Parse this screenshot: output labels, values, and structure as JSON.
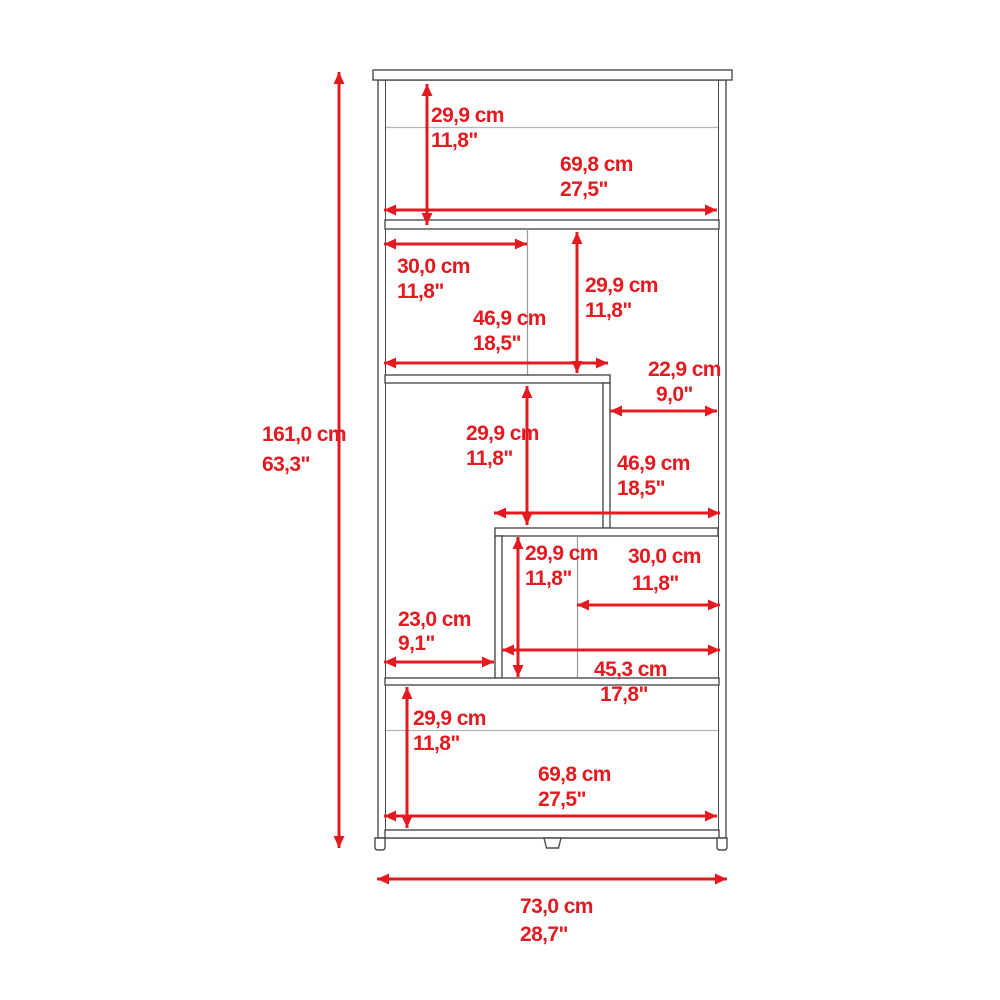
{
  "diagram": {
    "kind": "furniture-dimension-diagram",
    "units_primary": "cm",
    "units_secondary": "inches",
    "colors": {
      "annotation_red": "#e51a20",
      "outline_gray": "#4c4c4c",
      "light_gray": "#b5b5b5",
      "background": "#ffffff"
    },
    "dimensions": {
      "total_height": {
        "cm": "161,0 cm",
        "inch": "63,3\""
      },
      "total_width": {
        "cm": "73,0 cm",
        "inch": "28,7\""
      },
      "cube1_height": {
        "cm": "29,9 cm",
        "inch": "11,8\""
      },
      "cube1_width": {
        "cm": "69,8 cm",
        "inch": "27,5\""
      },
      "cube2_left_width": {
        "cm": "30,0 cm",
        "inch": "11,8\""
      },
      "cube2_height": {
        "cm": "29,9 cm",
        "inch": "11,8\""
      },
      "cube2_width": {
        "cm": "46,9 cm",
        "inch": "18,5\""
      },
      "niche_right_width": {
        "cm": "22,9 cm",
        "inch": "9,0\""
      },
      "cube3_height": {
        "cm": "29,9 cm",
        "inch": "11,8\""
      },
      "niche_right_height_width": {
        "cm": "46,9 cm",
        "inch": "18,5\""
      },
      "cube4_height": {
        "cm": "29,9 cm",
        "inch": "11,8\""
      },
      "cube4_right_width": {
        "cm": "30,0 cm",
        "inch": "11,8\""
      },
      "niche_left_width": {
        "cm": "23,0 cm",
        "inch": "9,1\""
      },
      "cube4_width": {
        "cm": "45,3 cm",
        "inch": "17,8\""
      },
      "cube5_height": {
        "cm": "29,9 cm",
        "inch": "11,8\""
      },
      "cube5_width": {
        "cm": "69,8 cm",
        "inch": "27,5\""
      }
    }
  }
}
